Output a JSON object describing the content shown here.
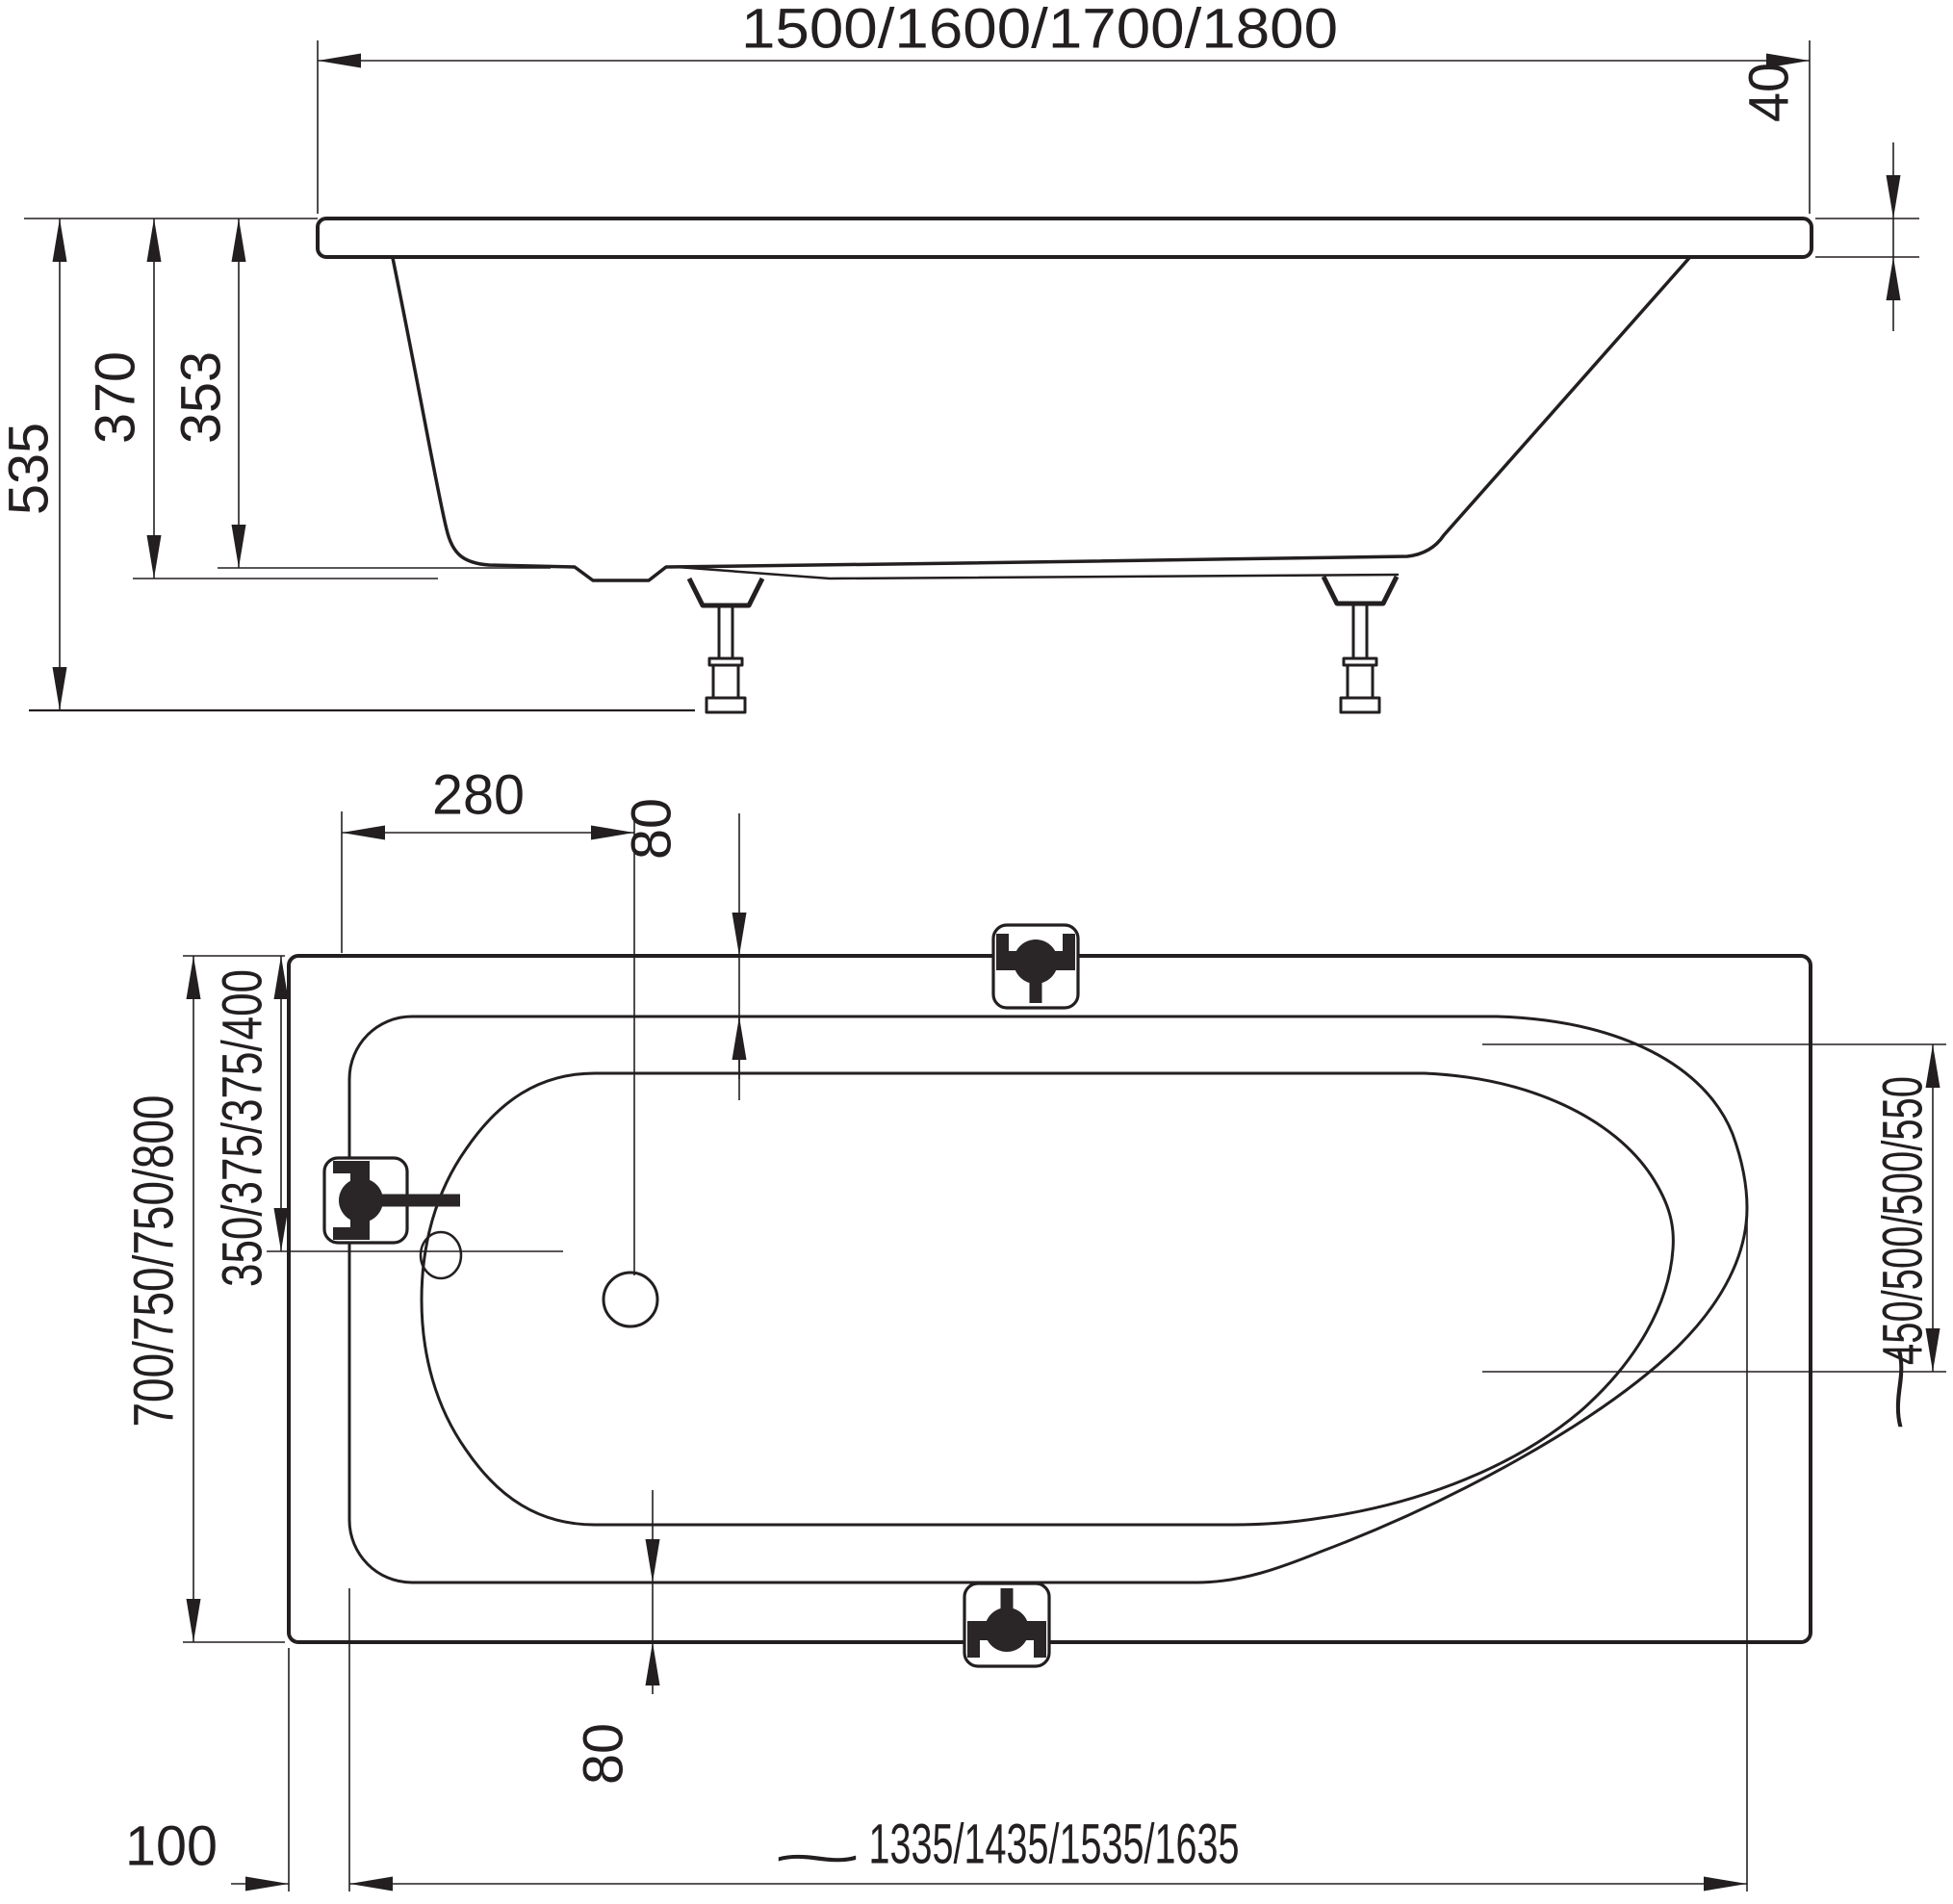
{
  "title": "Bathtub technical dimension drawing",
  "side": {
    "overall_length": "1500/1600/1700/1800",
    "rim_thickness": "40",
    "overall_height": "535",
    "rim_height": "370",
    "shell_height": "353"
  },
  "plan": {
    "drain_from_foot_end": "280",
    "rim_inset_top": "80",
    "overall_width": "700/750/750/800",
    "drain_from_side": "350/375/375/400",
    "head_end_width": "450/500/500/550",
    "rim_inset_bottom": "80",
    "foot_end_inset": "100",
    "inner_length": "1335/1435/1535/1635",
    "approx_symbol": "~"
  },
  "colors": {
    "line": "#231f20",
    "fitting_fill": "#2a2526",
    "background": "#ffffff"
  }
}
